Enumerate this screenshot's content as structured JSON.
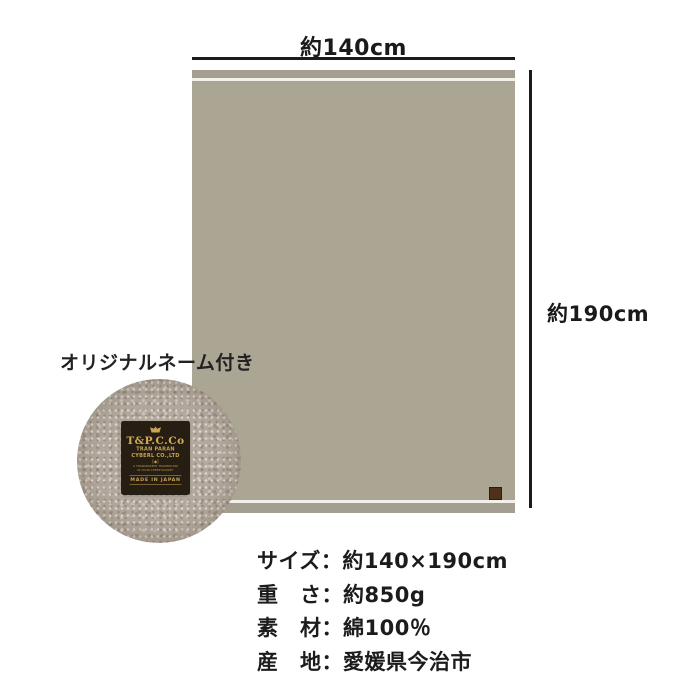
{
  "dimension_diagram": {
    "width_label": "約140cm",
    "height_label": "約190cm",
    "line_color": "#1b1b1b",
    "blanket": {
      "body_color": "#aba594",
      "band_color": "#a49e90",
      "seam_color": "#f2f0ea",
      "corner_tag_color": "#4e3118"
    }
  },
  "inset": {
    "caption": "オリジナルネーム付き",
    "woven_label": {
      "brand": "T&P.C.Co",
      "sub1": "TRAN PARAN",
      "sub2": "CYBERL CO.,LTD",
      "mark": "[◆]",
      "micro1": "A TRANSPARENT TRAMROUND",
      "micro2": "IN YOUR CHEEP KOOKEY",
      "footer": "MADE IN JAPAN",
      "bg_color": "#271e13",
      "text_color": "#c9a455",
      "fabric_color": "#b3a99e"
    }
  },
  "specs": {
    "separator": "：",
    "rows": [
      {
        "label": "サイズ",
        "value": "約140×190cm"
      },
      {
        "label": "重　さ",
        "value": "約850g"
      },
      {
        "label": "素　材",
        "value": "綿100％"
      },
      {
        "label": "産　地",
        "value": "愛媛県今治市"
      }
    ]
  }
}
